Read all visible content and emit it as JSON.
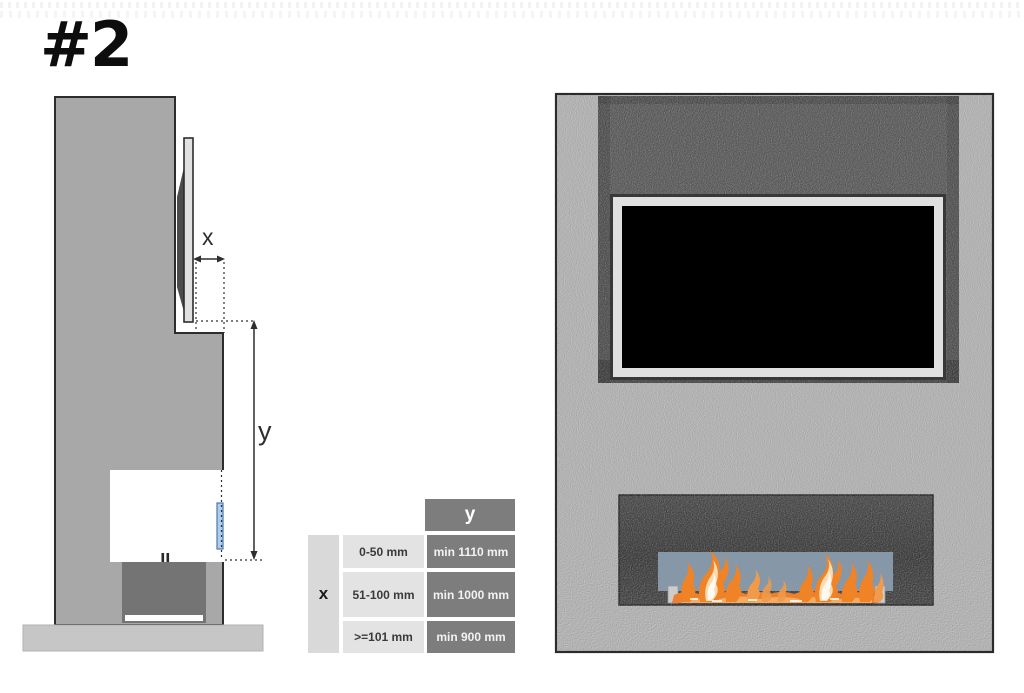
{
  "title": {
    "label": "#2"
  },
  "dimension_labels": {
    "x": "x",
    "y": "y"
  },
  "clearance_table": {
    "x_header": "x",
    "y_header": "y",
    "rows": [
      {
        "x_range": "0-50 mm",
        "y_min": "min 1110 mm"
      },
      {
        "x_range": "51-100 mm",
        "y_min": "min 1000 mm"
      },
      {
        "x_range": ">=101 mm",
        "y_min": "min 900 mm"
      }
    ]
  },
  "colors": {
    "side_wall_gray": "#a8a8a8",
    "front_wall_gray": "#b4b4b4",
    "alcove_dark": "#5b5b5b",
    "firebox_dark": "#424242",
    "flame_orange": "#ee7f2c",
    "flame_highlight": "#f8b36a",
    "front_glass_blue": "#8da0b3",
    "side_glass_blue": "#aecdec",
    "table_dark_cell": "#7d7d7d",
    "table_light_cell": "#e3e3e3",
    "plinth_gray": "#c6c6c6"
  }
}
